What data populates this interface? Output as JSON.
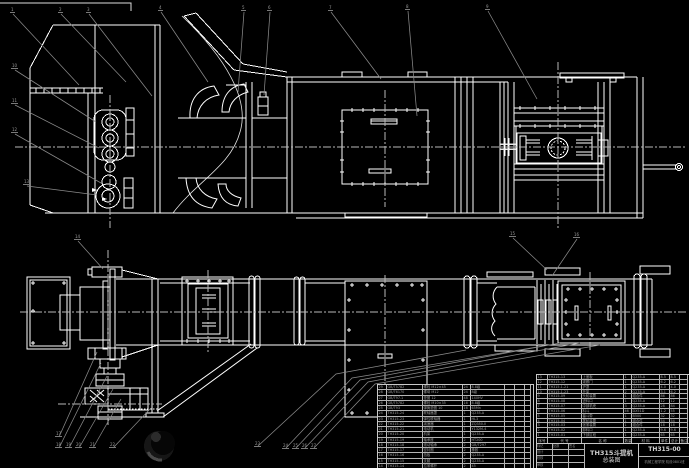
{
  "colors": {
    "background": "#000000",
    "line": "#ffffff",
    "leader": "#8a8a8a",
    "centerline": "#b8b8b8",
    "table_border": "#c8c8c8",
    "table_text": "#9f9f9f",
    "title_text": "#cfcfcf"
  },
  "title_block": {
    "product": "TH315斗提机",
    "sheet": "总装图",
    "number": "TH315-00",
    "org": "机械工程学院 机设0801班",
    "grid_labels": [
      "标记",
      "处数",
      "签名",
      "设计",
      "",
      "",
      "校核",
      "",
      "",
      "审核",
      "",
      ""
    ]
  },
  "bom": {
    "header": [
      "序号",
      "代 号",
      "名 称",
      "数量",
      "材 料",
      "单件",
      "总计",
      "备注"
    ],
    "right_rows": [
      [
        "13",
        "TH315-13",
        "上盖板",
        "1",
        "Q235-A",
        "8.5",
        "8.5",
        ""
      ],
      [
        "12",
        "TH315-12",
        "观察门",
        "1",
        "Q235-A",
        "6.2",
        "6.2",
        ""
      ],
      [
        "11",
        "TH315.1-21",
        "护罩",
        "1",
        "Q235-A",
        "4.0",
        "4.0",
        ""
      ],
      [
        "10",
        "TH315.1-23",
        "托架",
        "2",
        "Q235-A",
        "3.1",
        "6.2",
        ""
      ],
      [
        "9",
        "TH315-09",
        "头轮装置",
        "1",
        "组合件",
        "86",
        "86",
        ""
      ],
      [
        "8",
        "TH315-08",
        "进料口",
        "1",
        "Q235-A",
        "12",
        "12",
        ""
      ],
      [
        "7",
        "TH315-07",
        "中部机壳",
        "3",
        "Q235-A",
        "28",
        "84",
        ""
      ],
      [
        "6",
        "TH315-06",
        "料斗",
        "46",
        "DX51D",
        "1.2",
        "55",
        ""
      ],
      [
        "5",
        "TH315-05",
        "畚斗带",
        "1",
        "B500",
        "32",
        "32",
        ""
      ],
      [
        "4",
        "TH315-04",
        "尾轮装置",
        "1",
        "组合件",
        "54",
        "54",
        ""
      ],
      [
        "3",
        "TH315-03",
        "张紧装置",
        "1",
        "组合件",
        "18",
        "18",
        ""
      ],
      [
        "2",
        "TH315-02",
        "卸料口",
        "1",
        "Q235-A",
        "9.6",
        "9.6",
        ""
      ],
      [
        "1",
        "TH315-01",
        "下部区段",
        "1",
        "Q235-A",
        "65",
        "65",
        ""
      ]
    ],
    "left_rows": [
      [
        "29",
        "GB/T5782",
        "螺栓 M12×45",
        "24",
        "8.8级",
        "",
        "",
        ""
      ],
      [
        "28",
        "GB/T6170",
        "螺母 M12",
        "24",
        "8级",
        "",
        "",
        ""
      ],
      [
        "27",
        "GB/T97.1",
        "垫圈 12",
        "48",
        "140HV",
        "",
        "",
        ""
      ],
      [
        "26",
        "GB/T5782",
        "螺栓 M10×35",
        "16",
        "8.8级",
        "",
        "",
        ""
      ],
      [
        "25",
        "GB/T93",
        "弹簧垫圈 10",
        "16",
        "65Mn",
        "",
        "",
        ""
      ],
      [
        "24",
        "TH315-24",
        "联轴器罩",
        "1",
        "Q235-A",
        "",
        "",
        ""
      ],
      [
        "23",
        "TH315-23",
        "弹性联轴器",
        "1",
        "HL3",
        "",
        "",
        ""
      ],
      [
        "22",
        "TH315-22",
        "减速器",
        "1",
        "ZQ350-Ⅱ",
        "",
        "",
        ""
      ],
      [
        "21",
        "TH315-21",
        "电动机",
        "1",
        "Y132M-4",
        "",
        "",
        ""
      ],
      [
        "20",
        "TH315-20",
        "机架",
        "1",
        "Q235-A",
        "",
        "",
        ""
      ],
      [
        "19",
        "TH315-19",
        "轴承座",
        "2",
        "HT200",
        "",
        "",
        ""
      ],
      [
        "18",
        "TH315-18",
        "滚动轴承",
        "2",
        "GB/T297",
        "",
        "",
        ""
      ],
      [
        "17",
        "TH315-17",
        "密封圈",
        "2",
        "橡胶",
        "",
        "",
        ""
      ],
      [
        "16",
        "TH315-16",
        "挡板",
        "2",
        "Q235-A",
        "",
        "",
        ""
      ],
      [
        "15",
        "TH315-15",
        "支腿",
        "2",
        "Q235-A",
        "",
        "",
        ""
      ],
      [
        "14",
        "TH315-14",
        "拉紧螺杆",
        "2",
        "45",
        "",
        "",
        ""
      ]
    ]
  },
  "callouts": [
    {
      "x": 10,
      "y": 8,
      "n": "1"
    },
    {
      "x": 58,
      "y": 8,
      "n": "2"
    },
    {
      "x": 86,
      "y": 8,
      "n": "3"
    },
    {
      "x": 158,
      "y": 6,
      "n": "4"
    },
    {
      "x": 241,
      "y": 6,
      "n": "5"
    },
    {
      "x": 267,
      "y": 6,
      "n": "6"
    },
    {
      "x": 328,
      "y": 6,
      "n": "7"
    },
    {
      "x": 405,
      "y": 5,
      "n": "8"
    },
    {
      "x": 485,
      "y": 5,
      "n": "9"
    },
    {
      "x": 11,
      "y": 64,
      "n": "10"
    },
    {
      "x": 11,
      "y": 99,
      "n": "11"
    },
    {
      "x": 11,
      "y": 128,
      "n": "12"
    },
    {
      "x": 23,
      "y": 180,
      "n": "13"
    },
    {
      "x": 74,
      "y": 235,
      "n": "14"
    },
    {
      "x": 509,
      "y": 232,
      "n": "15"
    },
    {
      "x": 573,
      "y": 233,
      "n": "16"
    },
    {
      "x": 55,
      "y": 432,
      "n": "17"
    },
    {
      "x": 55,
      "y": 443,
      "n": "18"
    },
    {
      "x": 65,
      "y": 443,
      "n": "19"
    },
    {
      "x": 75,
      "y": 443,
      "n": "20"
    },
    {
      "x": 89,
      "y": 443,
      "n": "21"
    },
    {
      "x": 109,
      "y": 443,
      "n": "22"
    },
    {
      "x": 254,
      "y": 442,
      "n": "23"
    },
    {
      "x": 282,
      "y": 444,
      "n": "24"
    },
    {
      "x": 292,
      "y": 444,
      "n": "25"
    },
    {
      "x": 301,
      "y": 444,
      "n": "26"
    },
    {
      "x": 310,
      "y": 444,
      "n": "27"
    }
  ]
}
